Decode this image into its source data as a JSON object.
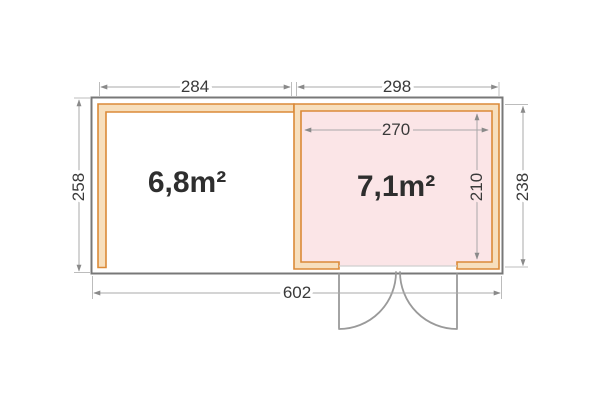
{
  "plan": {
    "rooms": [
      {
        "name": "left-room",
        "area_label": "6,8m²"
      },
      {
        "name": "right-room",
        "area_label": "7,1m²"
      }
    ],
    "dimensions": {
      "left_width": "284",
      "right_width": "298",
      "right_inner_width": "270",
      "left_depth": "258",
      "right_inner_depth": "210",
      "right_depth": "238",
      "total_width": "602"
    },
    "colors": {
      "wall_outline_orange": "#db8a38",
      "wall_fill_peach": "#f7dfbd",
      "room_fill_pink": "#fbe5e7",
      "base_outline_gray": "#787878",
      "dimension_gray": "#a8a8a8",
      "door_gray": "#9a9a9a",
      "text_dark": "#3a3a3a"
    }
  }
}
